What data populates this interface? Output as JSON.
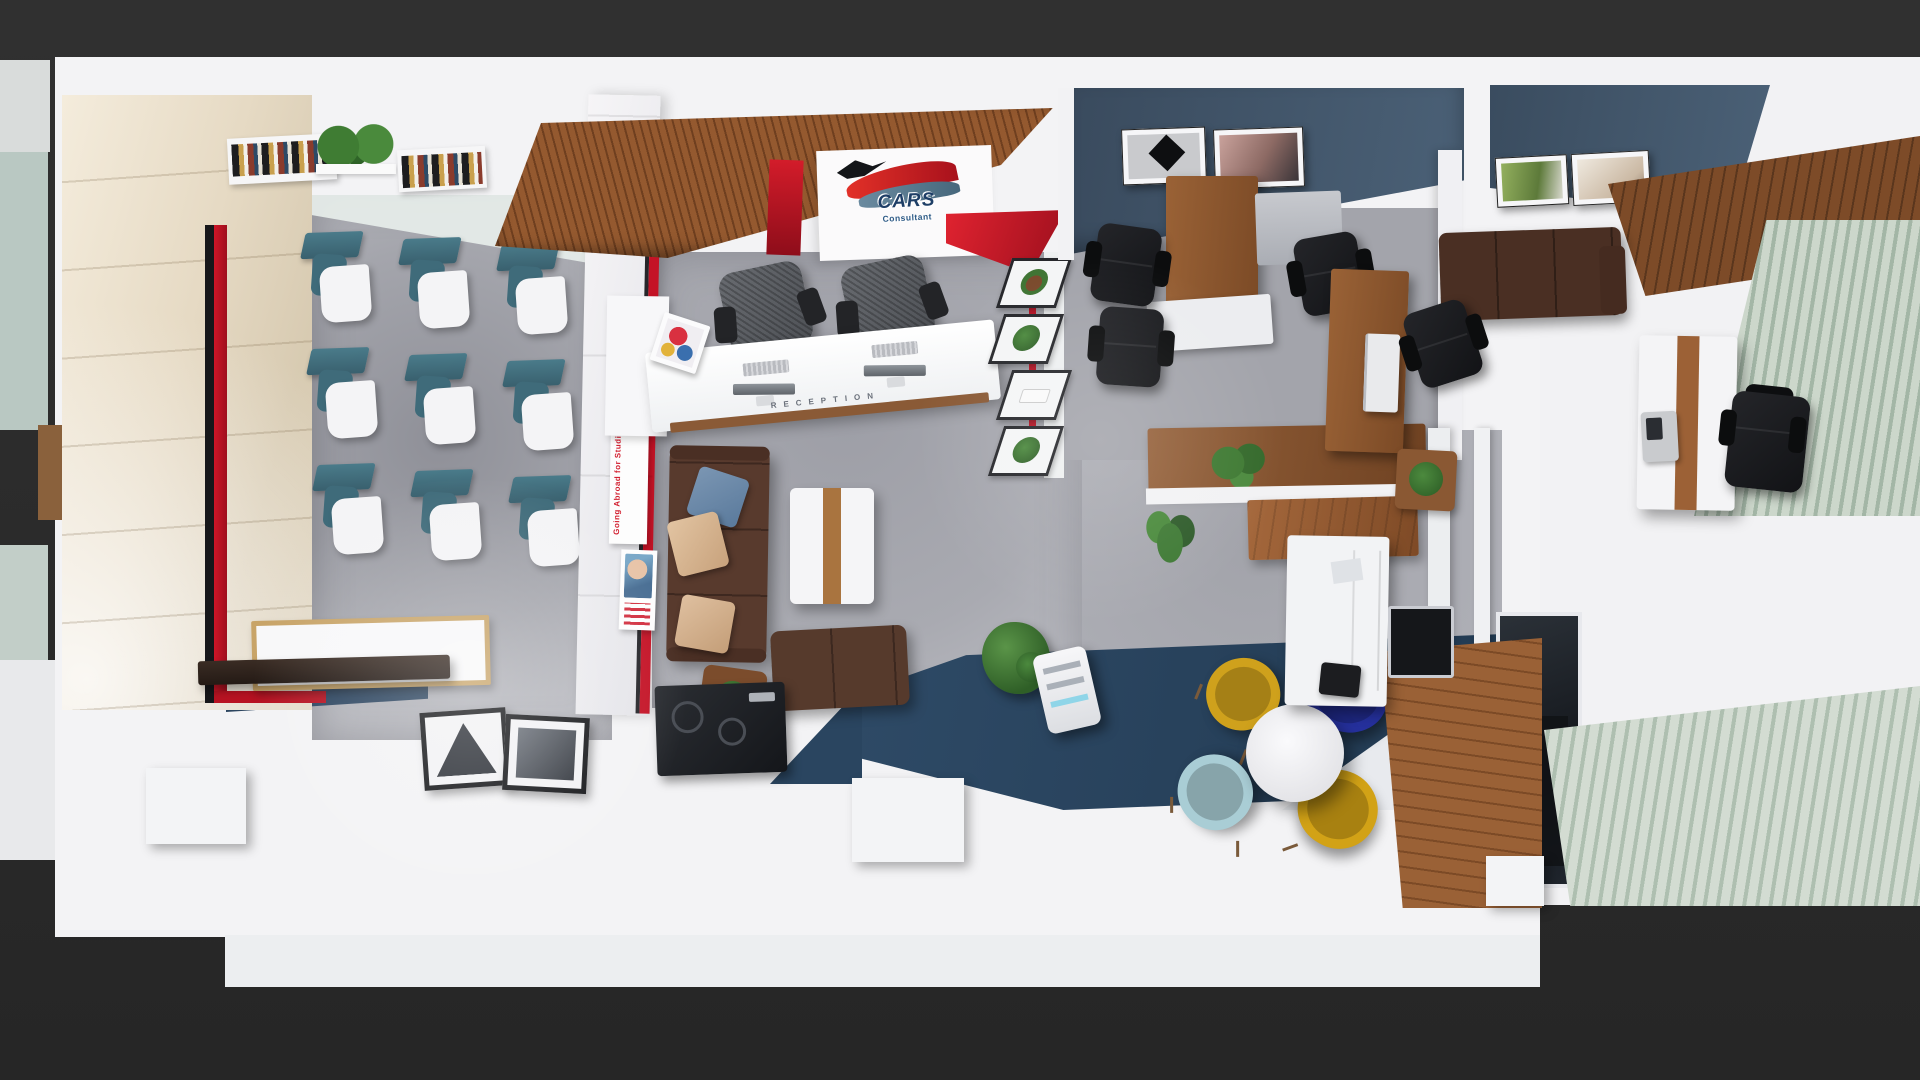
{
  "scene": {
    "kind": "architectural-3d-render",
    "view": "top-down floor plan",
    "description": "Top-down 3D render of a consultancy office: training classroom, reception with lounge, staff office, cafe corner, executive office and blue terrace",
    "background": "#2b2b2b"
  },
  "branding": {
    "logo_text": "CARS",
    "logo_tagline": "Consultant",
    "colors": {
      "swoosh_red": "#d21f2a",
      "swoosh_slate": "#5b7e93",
      "text_navy": "#1e3e66",
      "bird_black": "#15181c"
    }
  },
  "reception": {
    "counter_label": "RECEPTION",
    "workstations": 2,
    "chairs": 2,
    "equipment": [
      "keyboard",
      "keyboard",
      "monitor",
      "monitor",
      "magazine"
    ]
  },
  "posters": [
    {
      "title": "Going Abroad for Studies?",
      "accent": "#d21f2f"
    },
    {
      "title": ""
    }
  ],
  "classroom": {
    "desks": 9,
    "layout": "3 x 3 tablet-arm chairs",
    "desk_top_color": "#46798a",
    "accent_stripe_colors": [
      "#17171a",
      "#c81122"
    ],
    "fixtures": [
      "wall bookshelf",
      "potted shelf plants",
      "wall bookshelf",
      "whiteboard",
      "marker tray"
    ]
  },
  "lounge": {
    "sofa_color": "#583a2d",
    "cushions": [
      "denim blue",
      "beige",
      "beige"
    ],
    "furniture": [
      "3-seat sofa",
      "2-seat sofa",
      "coffee table with wood inlay",
      "plant side table"
    ]
  },
  "staff_office": {
    "wall_color": "#42586d",
    "wall_art": 2,
    "furniture": [
      "task chair",
      "task chair",
      "executive chair",
      "wood desk",
      "side desk",
      "white return desk",
      "credenza with bonsai",
      "service counter",
      "palm plant"
    ]
  },
  "cafe": {
    "table": "round white",
    "chair_colors": [
      "#cfa11c",
      "#25309c",
      "#a9cdd5",
      "#d2a216"
    ]
  },
  "executive_office": {
    "wall_art": 2,
    "blinds_color": "#c2d0c3",
    "furniture": [
      "leather sofa",
      "wood slat console",
      "white desk with wood inlay",
      "desk phone",
      "executive chair",
      "wood desk with monitor",
      "plant table",
      "venetian blinds",
      "wood deck"
    ]
  },
  "corridor": {
    "terrace_color": "#2c4560",
    "features": [
      "zigzag plant shelf",
      "red accent line",
      "dark blue terrace floor",
      "kitchenette counter",
      "printer cart",
      "shrub planter",
      "glass partition",
      "floor picture frames"
    ]
  },
  "palette": {
    "slab": "#f3f3f5",
    "concrete_floor": "#a5a6ae",
    "wood": "#8a5833",
    "accent_red": "#c81122",
    "dark_blue_floor": "#2c4560",
    "slate_wall": "#42586d"
  }
}
